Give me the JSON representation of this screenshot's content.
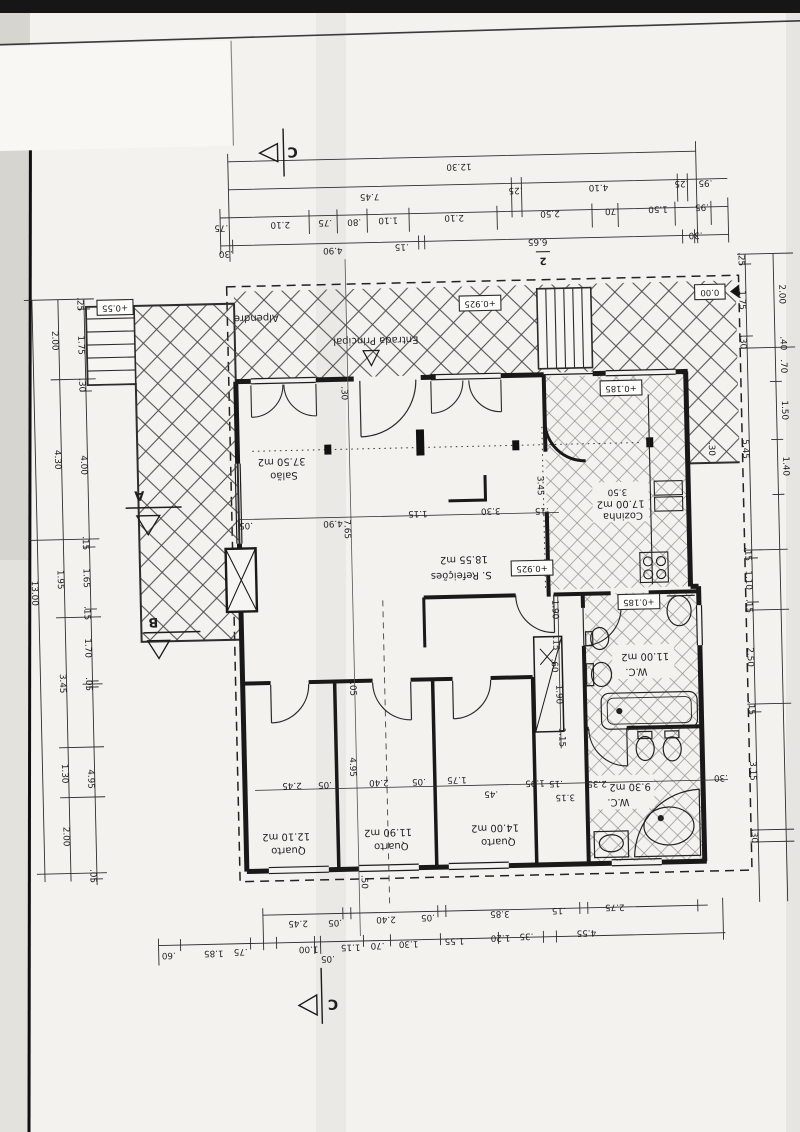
{
  "sheet": {
    "number": "2"
  },
  "rooms": [
    {
      "name": "Salão",
      "area": "37.50 m2",
      "nx": 286,
      "ny": 473,
      "ax": 284,
      "ay": 459
    },
    {
      "name": "Cozinha",
      "area": "17.00 m2",
      "nx": 624,
      "ny": 521,
      "ax": 622,
      "ay": 509
    },
    {
      "name": "S. Refeições",
      "area": "18.55 m2",
      "nx": 461,
      "ny": 577,
      "ax": 464,
      "ay": 561
    },
    {
      "name": "W.C.",
      "area": "11.00 m2",
      "nx": 634,
      "ny": 677,
      "ax": 643,
      "ay": 662
    },
    {
      "name": "W.C.",
      "area": "9.30 m2",
      "nx": 613,
      "ny": 807,
      "ax": 625,
      "ay": 792
    },
    {
      "name": "Quarto",
      "area": "12.10 m2",
      "nx": 282,
      "ny": 848,
      "ax": 280,
      "ay": 834
    },
    {
      "name": "Quarto",
      "area": "11.90 m2",
      "nx": 385,
      "ny": 846,
      "ax": 382,
      "ay": 832
    },
    {
      "name": "Quarto",
      "area": "14.00 m2",
      "nx": 492,
      "ny": 844,
      "ax": 489,
      "ay": 830
    }
  ],
  "notes": [
    {
      "t": "Alpendre",
      "x": 262,
      "y": 315
    },
    {
      "t": "Entrada Principal",
      "x": 381,
      "y": 340
    }
  ],
  "levels": [
    {
      "t": "+0.55",
      "x": 121,
      "y": 301
    },
    {
      "t": "+0.925",
      "x": 486,
      "y": 305
    },
    {
      "t": "0.00",
      "x": 716,
      "y": 299
    },
    {
      "t": "+0.185",
      "x": 625,
      "y": 393
    },
    {
      "t": "+0.925",
      "x": 532,
      "y": 571
    },
    {
      "t": "+0.185",
      "x": 638,
      "y": 607
    }
  ],
  "sections": [
    {
      "t": "C",
      "x": 302,
      "y": 149,
      "s": 14
    },
    {
      "t": "2",
      "x": 550,
      "y": 264,
      "s": 10
    },
    {
      "t": "A",
      "x": 141,
      "y": 489,
      "s": 13
    },
    {
      "t": "B",
      "x": 152,
      "y": 616,
      "s": 13
    },
    {
      "t": "C",
      "x": 323,
      "y": 1002,
      "s": 14
    }
  ],
  "dims": [
    {
      "t": "12.30",
      "x": 468,
      "y": 168
    },
    {
      "t": "7.45",
      "x": 378,
      "y": 196
    },
    {
      "t": ".25",
      "x": 524,
      "y": 193
    },
    {
      "t": "4.10",
      "x": 607,
      "y": 192
    },
    {
      "t": ".25",
      "x": 690,
      "y": 190
    },
    {
      "t": ".95",
      "x": 714,
      "y": 190
    },
    {
      "t": ".75",
      "x": 229,
      "y": 224
    },
    {
      "t": "2.10",
      "x": 288,
      "y": 222
    },
    {
      "t": ".75",
      "x": 333,
      "y": 221
    },
    {
      "t": ".80",
      "x": 362,
      "y": 221
    },
    {
      "t": "1.10",
      "x": 396,
      "y": 220
    },
    {
      "t": "2.10",
      "x": 462,
      "y": 219
    },
    {
      "t": "2.50",
      "x": 558,
      "y": 217
    },
    {
      "t": ".70",
      "x": 620,
      "y": 216
    },
    {
      "t": "1.50",
      "x": 666,
      "y": 215
    },
    {
      "t": ".95",
      "x": 710,
      "y": 214
    },
    {
      "t": ".30",
      "x": 233,
      "y": 250
    },
    {
      "t": "4.90",
      "x": 340,
      "y": 249
    },
    {
      "t": ".15",
      "x": 409,
      "y": 247
    },
    {
      "t": "6.65",
      "x": 545,
      "y": 245
    },
    {
      "t": ".30",
      "x": 703,
      "y": 242
    },
    {
      "t": "13.00",
      "x": 34,
      "y": 585,
      "r": 90
    },
    {
      "t": "2.00",
      "x": 60,
      "y": 333,
      "r": 90
    },
    {
      "t": "4.30",
      "x": 60,
      "y": 452,
      "r": 90
    },
    {
      "t": "1.95",
      "x": 60,
      "y": 572,
      "r": 90
    },
    {
      "t": "3.45",
      "x": 60,
      "y": 676,
      "r": 90
    },
    {
      "t": "1.30",
      "x": 60,
      "y": 766,
      "r": 90
    },
    {
      "t": "2.00",
      "x": 60,
      "y": 829,
      "r": 90
    },
    {
      "t": ".25",
      "x": 86,
      "y": 297,
      "r": 90
    },
    {
      "t": "1.75",
      "x": 86,
      "y": 338,
      "r": 90
    },
    {
      "t": ".30",
      "x": 86,
      "y": 378,
      "r": 90
    },
    {
      "t": "4.00",
      "x": 86,
      "y": 458,
      "r": 90
    },
    {
      "t": ".15",
      "x": 86,
      "y": 536,
      "r": 90
    },
    {
      "t": "1.65",
      "x": 86,
      "y": 571,
      "r": 90
    },
    {
      "t": ".15",
      "x": 86,
      "y": 606,
      "r": 90
    },
    {
      "t": "1.70",
      "x": 86,
      "y": 641,
      "r": 90
    },
    {
      "t": ".05",
      "x": 86,
      "y": 677,
      "r": 90
    },
    {
      "t": "4.95",
      "x": 86,
      "y": 772,
      "r": 90
    },
    {
      "t": ".05",
      "x": 86,
      "y": 869,
      "r": 90
    },
    {
      "t": ".25",
      "x": 748,
      "y": 267,
      "r": 90
    },
    {
      "t": "1.75",
      "x": 748,
      "y": 308,
      "r": 90
    },
    {
      "t": ".30",
      "x": 748,
      "y": 350,
      "r": 90
    },
    {
      "t": "5.45",
      "x": 748,
      "y": 457,
      "r": 90
    },
    {
      "t": ".15",
      "x": 748,
      "y": 562,
      "r": 90
    },
    {
      "t": "1.10",
      "x": 748,
      "y": 588,
      "r": 90
    },
    {
      "t": ".15",
      "x": 748,
      "y": 614,
      "r": 90
    },
    {
      "t": "2.50",
      "x": 748,
      "y": 665,
      "r": 90
    },
    {
      "t": ".15",
      "x": 748,
      "y": 716,
      "r": 90
    },
    {
      "t": "3.15",
      "x": 748,
      "y": 779,
      "r": 90
    },
    {
      "t": ".30",
      "x": 748,
      "y": 844,
      "r": 90
    },
    {
      "t": "2.00",
      "x": 788,
      "y": 303,
      "r": 90
    },
    {
      "t": ".40",
      "x": 788,
      "y": 352,
      "r": 90
    },
    {
      "t": ".70",
      "x": 788,
      "y": 375,
      "r": 90
    },
    {
      "t": "1.50",
      "x": 788,
      "y": 419,
      "r": 90
    },
    {
      "t": "1.40",
      "x": 788,
      "y": 475,
      "r": 90
    },
    {
      "t": "2.45",
      "x": 290,
      "y": 921
    },
    {
      "t": ".05",
      "x": 327,
      "y": 921
    },
    {
      "t": "2.40",
      "x": 378,
      "y": 919
    },
    {
      "t": ".05",
      "x": 420,
      "y": 918
    },
    {
      "t": "3.85",
      "x": 492,
      "y": 916
    },
    {
      "t": ".15",
      "x": 551,
      "y": 914
    },
    {
      "t": "2.75",
      "x": 607,
      "y": 912
    },
    {
      "t": ".60",
      "x": 160,
      "y": 950
    },
    {
      "t": "1.85",
      "x": 205,
      "y": 949
    },
    {
      "t": ".75",
      "x": 232,
      "y": 948
    },
    {
      "t": "1.00",
      "x": 300,
      "y": 947
    },
    {
      "t": ".05",
      "x": 319,
      "y": 957
    },
    {
      "t": "1.15",
      "x": 342,
      "y": 946
    },
    {
      "t": ".70",
      "x": 369,
      "y": 945
    },
    {
      "t": "1.30",
      "x": 400,
      "y": 944
    },
    {
      "t": "1.55",
      "x": 446,
      "y": 942
    },
    {
      "t": "1.20",
      "x": 492,
      "y": 940
    },
    {
      "t": ".35",
      "x": 518,
      "y": 939
    },
    {
      "t": "4.55",
      "x": 578,
      "y": 937
    },
    {
      "t": ".05",
      "x": 247,
      "y": 522
    },
    {
      "t": "4.90",
      "x": 334,
      "y": 522
    },
    {
      "t": "1.15",
      "x": 419,
      "y": 514
    },
    {
      "t": "3.30",
      "x": 492,
      "y": 513
    },
    {
      "t": ".15",
      "x": 543,
      "y": 514
    },
    {
      "t": "7.65",
      "x": 348,
      "y": 528,
      "r": 90
    },
    {
      "t": "3.45",
      "x": 542,
      "y": 489,
      "r": 90
    },
    {
      "t": "4.95",
      "x": 348,
      "y": 766,
      "r": 90
    },
    {
      "t": ".05",
      "x": 350,
      "y": 688,
      "r": 90
    },
    {
      "t": ".30",
      "x": 348,
      "y": 392,
      "r": 90
    },
    {
      "t": "2.45",
      "x": 287,
      "y": 783
    },
    {
      "t": ".05",
      "x": 320,
      "y": 783
    },
    {
      "t": "2.40",
      "x": 374,
      "y": 782
    },
    {
      "t": ".05",
      "x": 414,
      "y": 782
    },
    {
      "t": "1.75",
      "x": 452,
      "y": 781
    },
    {
      "t": ".45",
      "x": 486,
      "y": 796
    },
    {
      "t": "1.95",
      "x": 530,
      "y": 786
    },
    {
      "t": ".15",
      "x": 551,
      "y": 787
    },
    {
      "t": "2.35",
      "x": 592,
      "y": 788
    },
    {
      "t": ".30",
      "x": 716,
      "y": 785
    },
    {
      "t": "3.15",
      "x": 560,
      "y": 801
    },
    {
      "t": "1.90",
      "x": 554,
      "y": 613,
      "r": 90
    },
    {
      "t": ".15",
      "x": 554,
      "y": 647,
      "r": 90
    },
    {
      "t": ".60",
      "x": 552,
      "y": 669,
      "r": 90
    },
    {
      "t": "1.90",
      "x": 556,
      "y": 698,
      "r": 90
    },
    {
      "t": "1.15",
      "x": 558,
      "y": 741,
      "r": 90
    },
    {
      "t": "3.50",
      "x": 619,
      "y": 497
    },
    {
      "t": ".50",
      "x": 357,
      "y": 881,
      "r": 90
    },
    {
      "t": ".30",
      "x": 714,
      "y": 456,
      "r": 90
    }
  ]
}
